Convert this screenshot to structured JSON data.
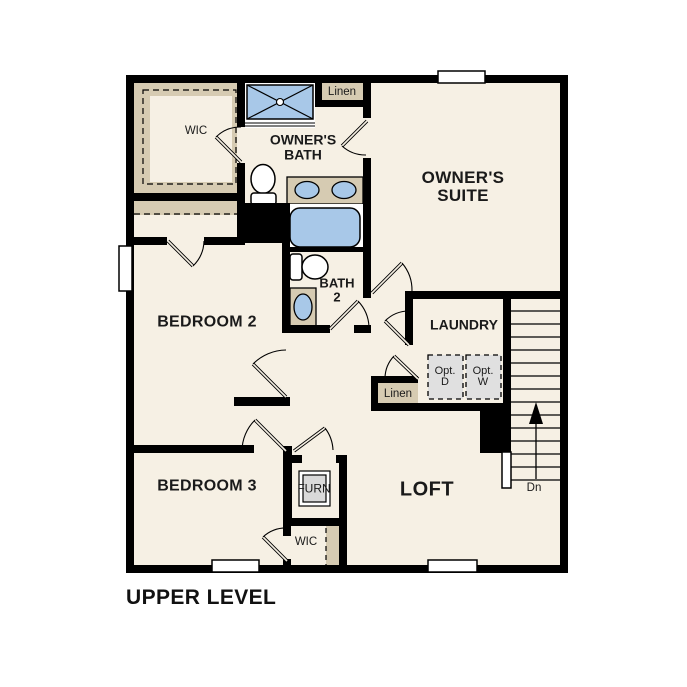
{
  "plan": {
    "title": "UPPER LEVEL"
  },
  "colors": {
    "paper": "#ffffff",
    "wall": "#000000",
    "floor": "#f6f0e4",
    "tan": "#d6cbb2",
    "fixture_blue": "#a8c8e8",
    "appliance_gray": "#e0e0e0",
    "furnace_gray": "#d9d9d9"
  },
  "labels": {
    "wic_top": "WIC",
    "linen_top": "Linen",
    "owners_bath_1": "OWNER'S",
    "owners_bath_2": "BATH",
    "owners_suite_1": "OWNER'S",
    "owners_suite_2": "SUITE",
    "bedroom2": "BEDROOM 2",
    "bath2_1": "BATH",
    "bath2_2": "2",
    "laundry": "LAUNDRY",
    "opt_d_1": "Opt.",
    "opt_d_2": "D",
    "opt_w_1": "Opt.",
    "opt_w_2": "W",
    "linen_mid": "Linen",
    "bedroom3": "BEDROOM 3",
    "furn": "FURN",
    "loft": "LOFT",
    "wic_bottom": "WIC",
    "stairs_dn": "Dn"
  }
}
